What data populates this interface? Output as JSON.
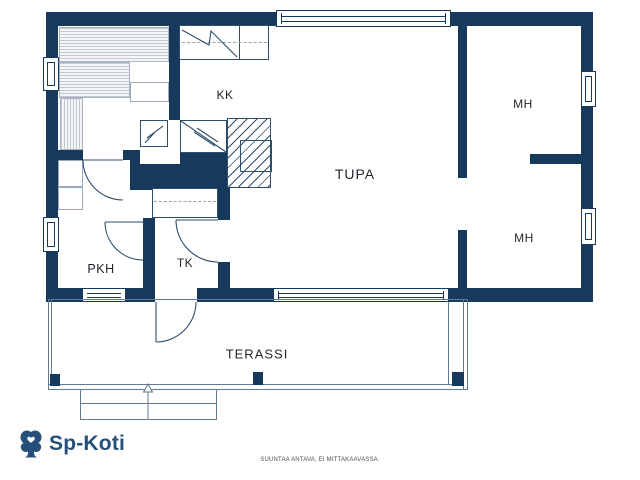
{
  "colors": {
    "wall": "#16395c",
    "line": "#2f4d6d",
    "deck_line": "#64798f",
    "hatch_line": "#c2c9d2",
    "hatch_bg": "#f4f5f7",
    "dash": "#9aa0a8",
    "label": "#23272d",
    "logo": "#26507b",
    "footer": "#4a4e55"
  },
  "plan": {
    "rooms": [
      {
        "id": "kk",
        "label": "KK"
      },
      {
        "id": "tupa",
        "label": "TUPA"
      },
      {
        "id": "mh-top",
        "label": "MH"
      },
      {
        "id": "mh-bottom",
        "label": "MH"
      },
      {
        "id": "pkh",
        "label": "PKH"
      },
      {
        "id": "tk",
        "label": "TK"
      },
      {
        "id": "terassi",
        "label": "TERASSI"
      }
    ],
    "symbols": [
      {
        "id": "stove-zigzag",
        "meaning": "electric stove symbol in kitchenette counter"
      },
      {
        "id": "sauna-heater-zigzag",
        "meaning": "electric heater symbol"
      },
      {
        "id": "fireplace-hatch",
        "meaning": "fireplace / chimney mass"
      },
      {
        "id": "bench-hatch",
        "meaning": "sauna benches"
      },
      {
        "id": "entrance-arrow",
        "meaning": "entrance direction marker at terrace steps"
      }
    ]
  },
  "footer": {
    "brand": "Sp-Koti",
    "disclaimer": "SUUNTAA ANTAVA, EI MITTAKAAVASSA."
  }
}
